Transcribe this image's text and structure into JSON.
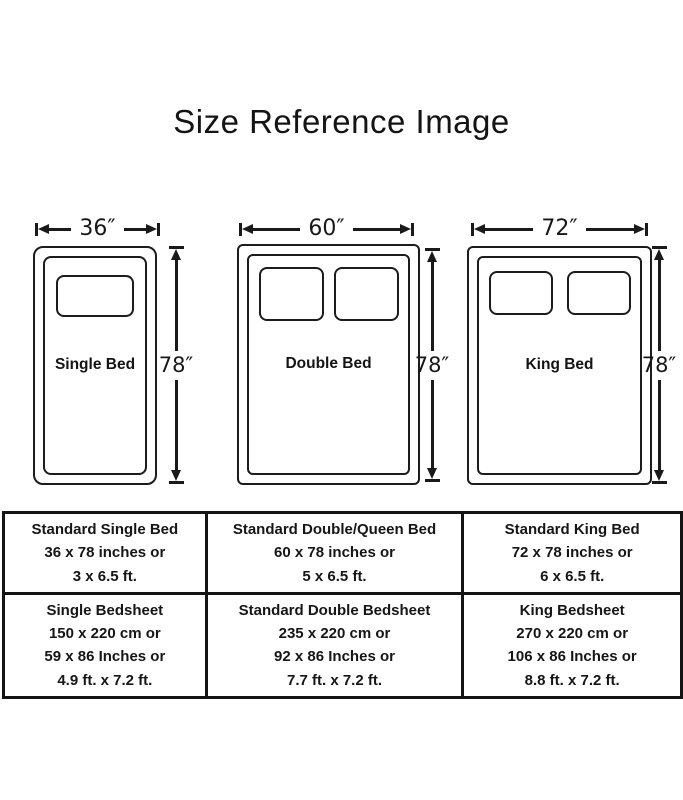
{
  "title": "Size Reference Image",
  "colors": {
    "ink": "#1a1a1a",
    "background": "#ffffff"
  },
  "beds": [
    {
      "name": "Single Bed",
      "width_label": "36″",
      "height_label": "78″",
      "pillows": 1
    },
    {
      "name": "Double Bed",
      "width_label": "60″",
      "height_label": "78″",
      "pillows": 2
    },
    {
      "name": "King Bed",
      "width_label": "72″",
      "height_label": "78″",
      "pillows": 2
    }
  ],
  "table": {
    "rows": [
      {
        "cells": [
          {
            "lines": [
              "Standard Single Bed",
              "36 x 78 inches or",
              "3 x 6.5 ft."
            ]
          },
          {
            "lines": [
              "Standard Double/Queen Bed",
              "60 x 78 inches or",
              "5 x 6.5 ft."
            ]
          },
          {
            "lines": [
              "Standard King Bed",
              "72 x 78 inches or",
              "6 x 6.5 ft."
            ]
          }
        ]
      },
      {
        "cells": [
          {
            "lines": [
              "Single Bedsheet",
              "150 x 220 cm or",
              "59 x 86 Inches or",
              "4.9 ft. x 7.2 ft."
            ]
          },
          {
            "lines": [
              "Standard Double Bedsheet",
              "235 x 220 cm or",
              "92 x 86 Inches or",
              "7.7 ft. x 7.2 ft."
            ]
          },
          {
            "lines": [
              "King Bedsheet",
              "270 x 220 cm or",
              "106 x 86 Inches or",
              "8.8 ft. x 7.2 ft."
            ]
          }
        ]
      }
    ]
  }
}
